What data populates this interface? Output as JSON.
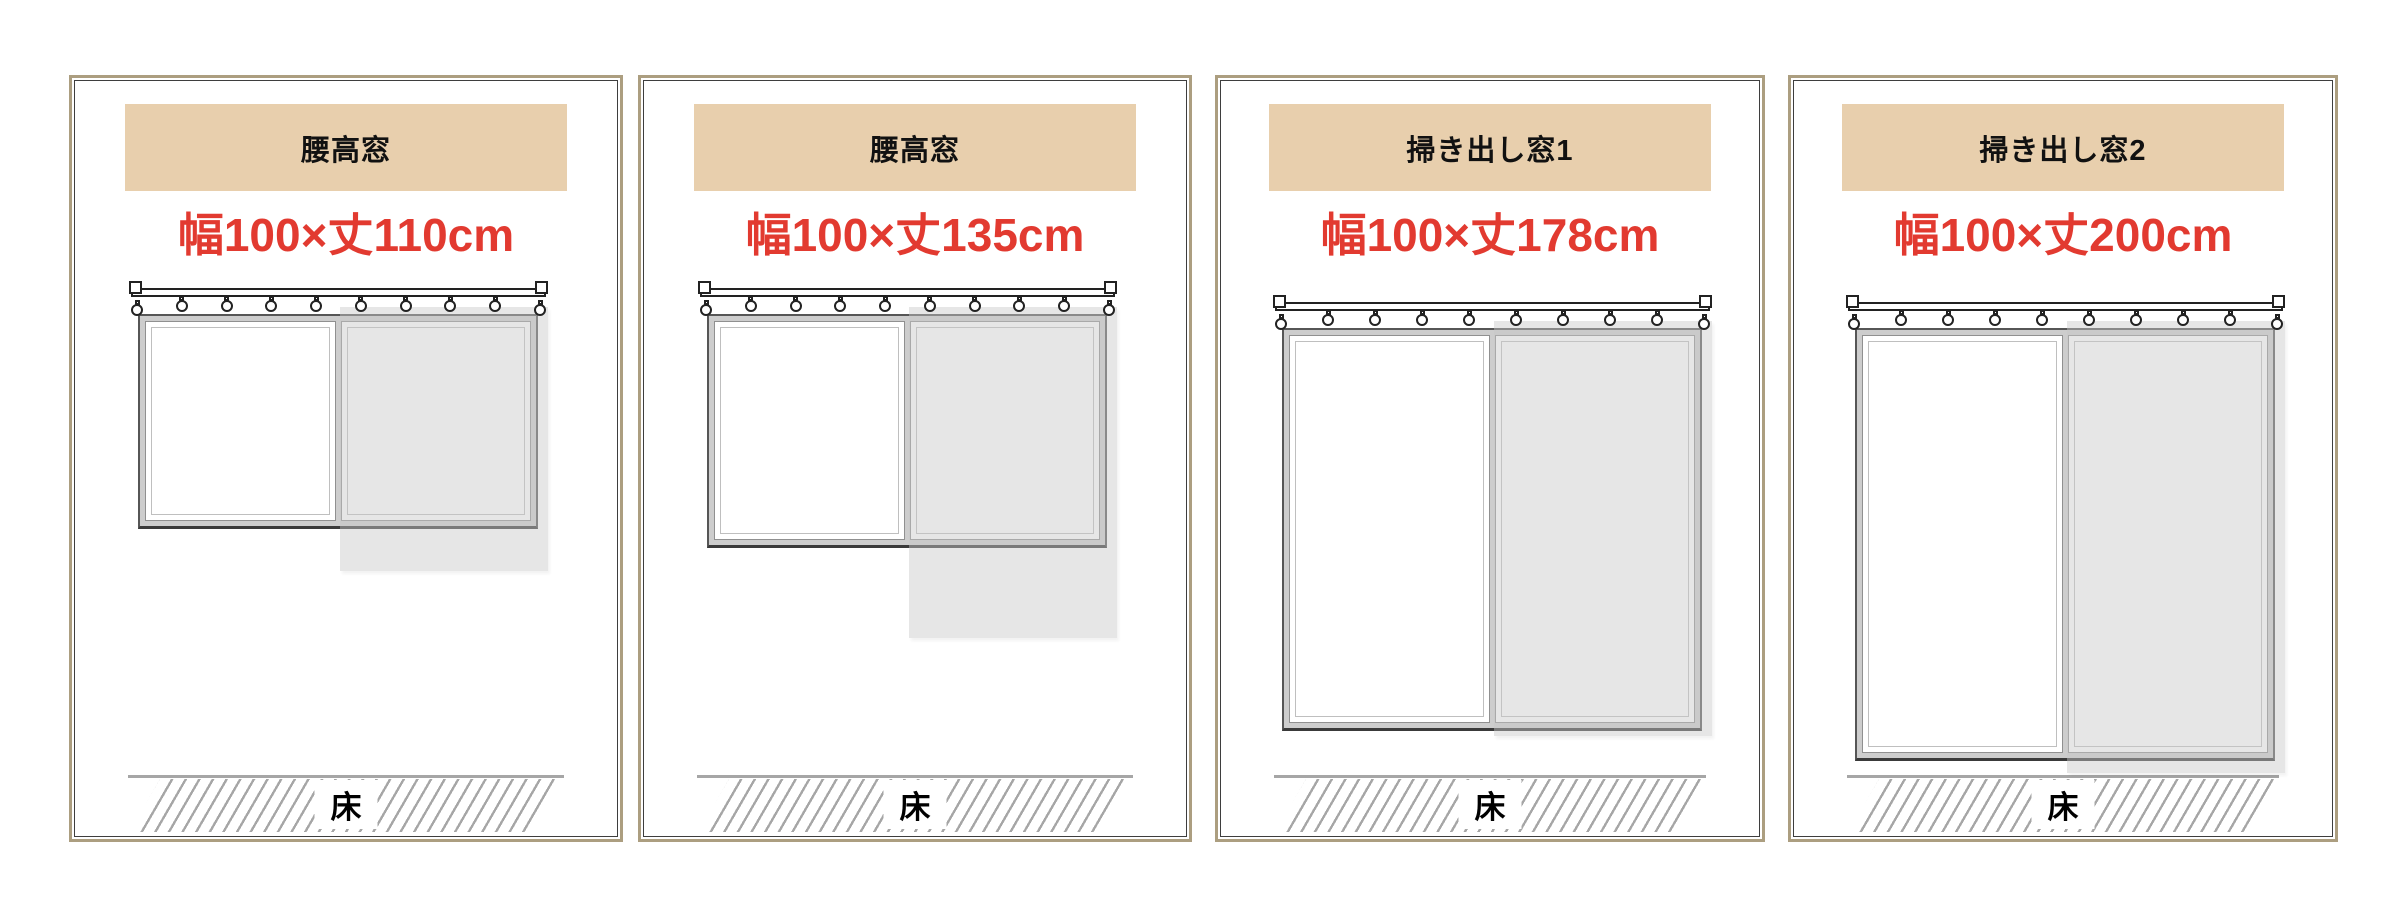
{
  "colors": {
    "accent_red": "#e23a30",
    "header_bg": "#e8cfad",
    "header_text": "#111111",
    "panel_border": "#ac9e80",
    "panel_inner_border": "#3e3e3e",
    "window_frame": "#cdcdcd",
    "window_frame_edge": "#565656",
    "curtain_gray": "rgba(200,200,200,0.45)",
    "floor_gray": "#a6a6a6",
    "rail_outline": "#222222"
  },
  "panels": [
    {
      "header": "腰高窓",
      "size_label": "幅100×丈110cm",
      "width_cm": 100,
      "length_cm": 110,
      "floor_label": "床",
      "figure": {
        "x": 69,
        "w": 554,
        "window": {
          "x": 66,
          "y": 236,
          "w": 400,
          "h": 215
        },
        "curtain_bottom": 493,
        "rings": 10
      }
    },
    {
      "header": "腰高窓",
      "size_label": "幅100×丈135cm",
      "width_cm": 100,
      "length_cm": 135,
      "floor_label": "床",
      "figure": {
        "x": 638,
        "w": 554,
        "window": {
          "x": 66,
          "y": 236,
          "w": 400,
          "h": 234
        },
        "curtain_bottom": 560,
        "rings": 10
      }
    },
    {
      "header": "掃き出し窓1",
      "size_label": "幅100×丈178cm",
      "width_cm": 100,
      "length_cm": 178,
      "floor_label": "床",
      "figure": {
        "x": 1215,
        "w": 550,
        "window": {
          "x": 64,
          "y": 250,
          "w": 420,
          "h": 403
        },
        "curtain_bottom": 658,
        "rings": 10
      }
    },
    {
      "header": "掃き出し窓2",
      "size_label": "幅100×丈200cm",
      "width_cm": 100,
      "length_cm": 200,
      "floor_label": "床",
      "figure": {
        "x": 1788,
        "w": 550,
        "window": {
          "x": 64,
          "y": 250,
          "w": 420,
          "h": 433
        },
        "curtain_bottom": 695,
        "rings": 10
      }
    }
  ]
}
